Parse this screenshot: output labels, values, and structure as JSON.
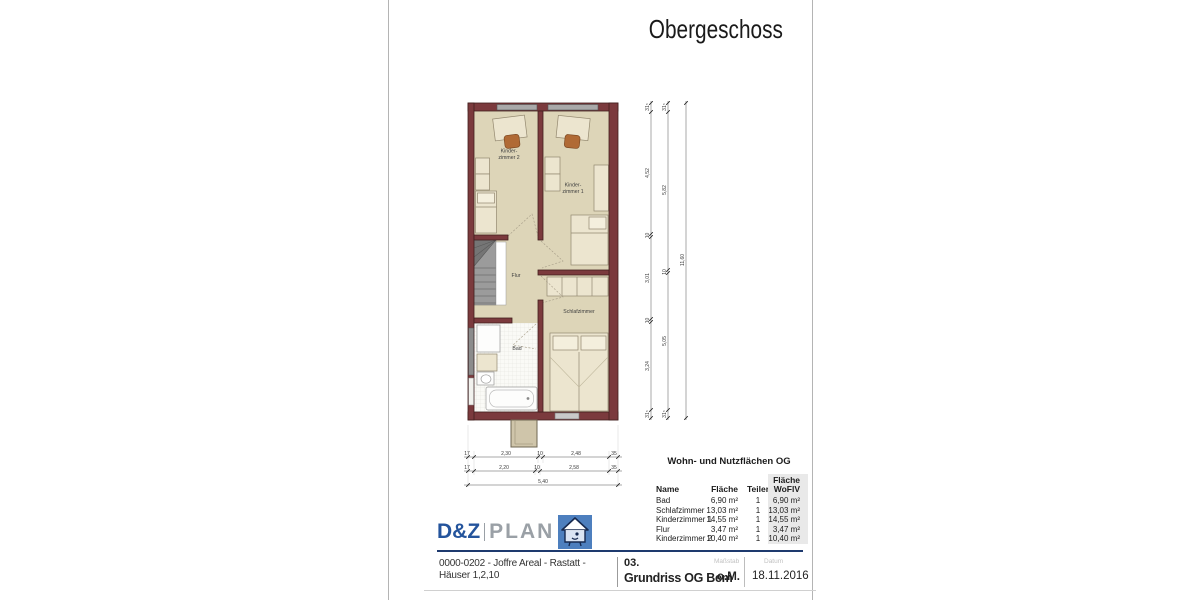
{
  "page": {
    "title": "Obergeschoss"
  },
  "plan": {
    "rooms": {
      "kz2": {
        "line1": "Kinder-",
        "line2": "zimmer 2"
      },
      "kz1": {
        "line1": "Kinder-",
        "line2": "zimmer 1"
      },
      "flur": "Flur",
      "schlafzimmer": "Schlafzimmer",
      "bad": "Bad"
    },
    "dims": {
      "bottom1": [
        "17",
        "2,30",
        "10",
        "2,48",
        "35"
      ],
      "bottom2": [
        "17",
        "2,20",
        "10",
        "2,58",
        "35"
      ],
      "bottom_total": "5,40",
      "right_inner": [
        "31⁵",
        "4,52",
        "10",
        "3,01",
        "10",
        "3,24",
        "31⁵"
      ],
      "right_mid": [
        "31⁵",
        "5,82",
        "10",
        "5,05",
        "31⁵"
      ],
      "right_total": "11,60"
    },
    "colors": {
      "wall": "#7b3a3d",
      "floor": "#ddd5b8",
      "furniture": "#ece5cf",
      "window": "#a9a9a9",
      "chair": "#b06a35"
    }
  },
  "table": {
    "title": "Wohn- und Nutzflächen OG",
    "headers": {
      "name": "Name",
      "flaeche": "Fläche",
      "teiler": "Teiler",
      "wofiv_line1": "Fläche",
      "wofiv_line2": "WoFlV"
    },
    "rows": [
      {
        "name": "Bad",
        "flaeche": "6,90 m²",
        "teiler": "1",
        "wofiv": "6,90 m²"
      },
      {
        "name": "Schlafzimmer",
        "flaeche": "13,03 m²",
        "teiler": "1",
        "wofiv": "13,03 m²"
      },
      {
        "name": "Kinderzimmer 1",
        "flaeche": "14,55 m²",
        "teiler": "1",
        "wofiv": "14,55 m²"
      },
      {
        "name": "Flur",
        "flaeche": "3,47 m²",
        "teiler": "1",
        "wofiv": "3,47 m²"
      },
      {
        "name": "Kinderzimmer 2",
        "flaeche": "10,40 m²",
        "teiler": "1",
        "wofiv": "10,40 m²"
      }
    ]
  },
  "logo": {
    "brand_primary": "D&Z",
    "brand_secondary": "PLAN",
    "icon": "house-logo",
    "brand_blue": "#24549c",
    "icon_blue": "#4d7fbe"
  },
  "footer": {
    "project_line1": "0000-0202 - Joffre Areal - Rastatt -",
    "project_line2": "Häuser 1,2,10",
    "sheet_number": "03.",
    "sheet_title": "Grundriss OG Bem",
    "scale_label": "Maßstab",
    "scale_value": "o.M.",
    "date_label": "Datum",
    "date_value": "18.11.2016"
  }
}
